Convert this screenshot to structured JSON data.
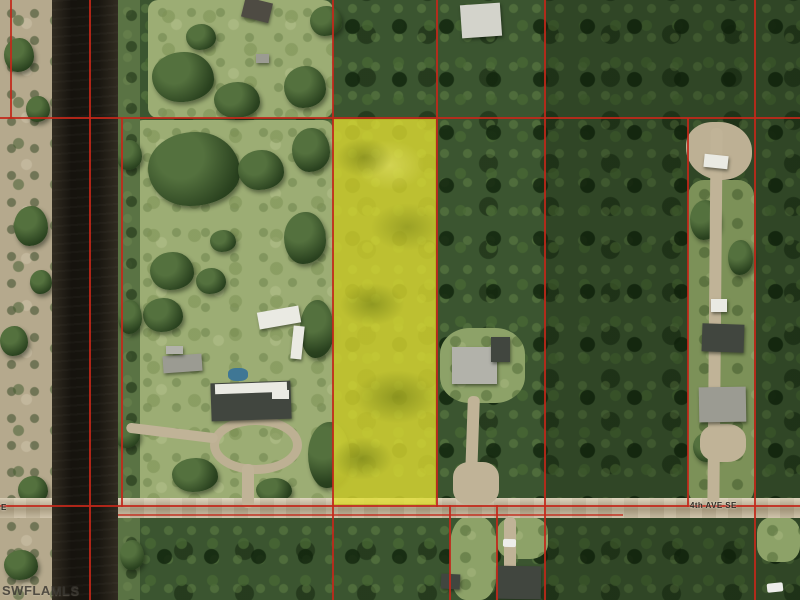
{
  "map": {
    "type": "aerial-parcel-map",
    "road": {
      "label": "4th AVE SE",
      "label_partial_left": "E"
    },
    "watermark": "SWFLAMLS",
    "colors": {
      "parcel_boundary": "#c3281a",
      "parcel_highlight": "#e2df3e",
      "canal_water": "#211d15",
      "road_surface": "#bfb298",
      "forest": "#3b5530",
      "pasture": "#9cad74",
      "scrub_bank": "#b5a98d"
    }
  }
}
